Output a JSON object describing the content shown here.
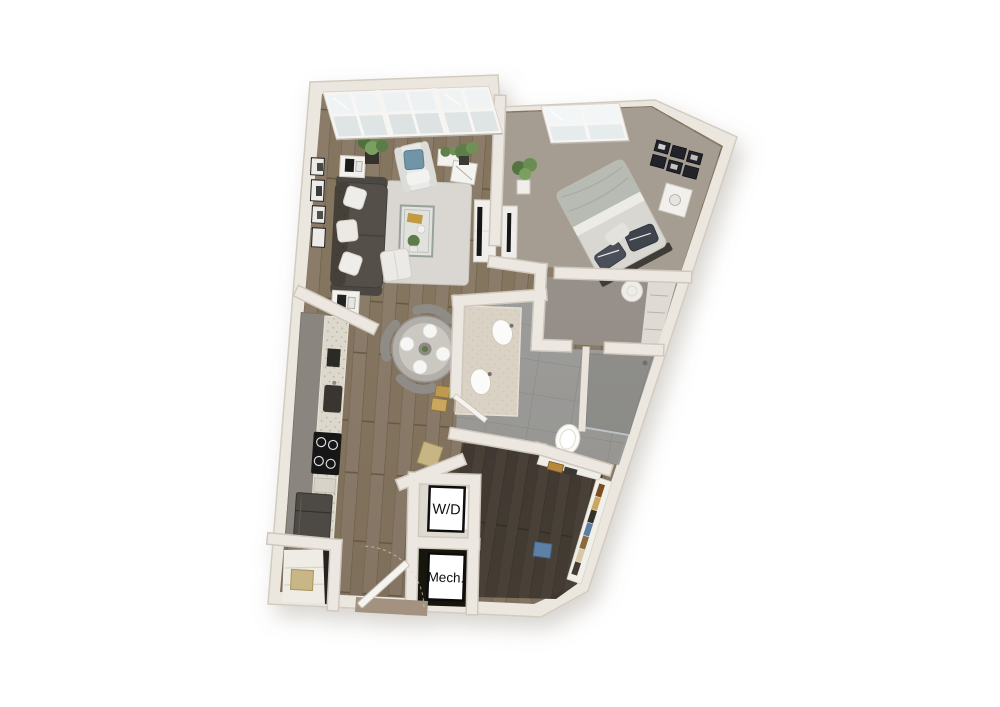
{
  "image": {
    "kind": "3d-apartment-floor-plan-render",
    "view": "top-down dollhouse",
    "background": "#ffffff"
  },
  "labels": {
    "washer_dryer": "W/D",
    "mechanical": "Mech."
  },
  "rooms": [
    {
      "name": "Living Room",
      "floor": "hardwood",
      "features": [
        "floor-to-ceiling window wall (3 bays)",
        "dark tufted sofa with white pillows",
        "area rug",
        "glass coffee table",
        "white armchair with teal pillow",
        "white ottoman",
        "media console with tv",
        "end tables",
        "black-and-white wall art",
        "potted plants"
      ]
    },
    {
      "name": "Dining Area",
      "floor": "hardwood",
      "features": [
        "round gray table",
        "four chairs",
        "four place settings"
      ]
    },
    {
      "name": "Kitchen",
      "floor": "hardwood",
      "features": [
        "galley cabinet run",
        "speckled countertop",
        "undermount sink",
        "4-burner cooktop",
        "refrigerator"
      ]
    },
    {
      "name": "Bedroom",
      "floor": "carpet",
      "features": [
        "bed with gray duvet and dark pillows",
        "nightstand",
        "round stool",
        "dresser with tv",
        "gallery wall of 6 frames",
        "window",
        "potted plant"
      ]
    },
    {
      "name": "Bedroom Closet",
      "floor": "carpet",
      "features": [
        "wire shelving"
      ]
    },
    {
      "name": "Bathroom",
      "floor": "gray tile",
      "features": [
        "double-sink vanity",
        "toilet",
        "walk-in shower with glass panel"
      ]
    },
    {
      "name": "Walk-in Closet",
      "floor": "dark hardwood",
      "features": [
        "shelf run along angled wall",
        "hanging clothes",
        "blue storage bin"
      ]
    },
    {
      "name": "Laundry Closet",
      "label": "W/D"
    },
    {
      "name": "Mechanical Closet",
      "label": "Mech."
    },
    {
      "name": "Entry",
      "floor": "hardwood",
      "features": [
        "front door ajar",
        "storage closet with basket"
      ]
    }
  ],
  "palette": {
    "background": "#ffffff",
    "wall": "#ebe7df",
    "wall_edge": "#d2cbc0",
    "wood_floor": "#8b7b6a",
    "dark_wood": "#463e36",
    "bedroom_carpet": "#a59d91",
    "closet_carpet": "#97908a",
    "tile": "#9c9c9a",
    "rug": "#dad7d2",
    "sofa": "#544f4a",
    "accent_pillow": "#7095a6",
    "duvet": "#b7bbb3",
    "gold_accent": "#bd9a4e",
    "label_text": "#111111"
  }
}
